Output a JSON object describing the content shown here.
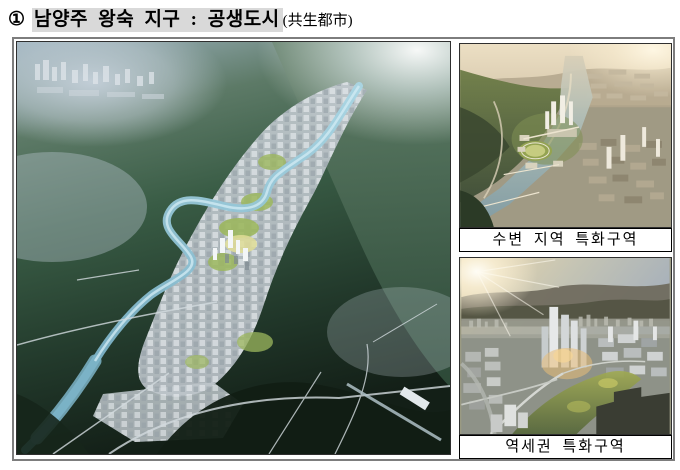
{
  "title": {
    "marker": "①",
    "highlighted": "남양주 왕숙 지구 : 공생도시",
    "suffix": "(共生都市)"
  },
  "captions": {
    "waterfront": "수변 지역 특화구역",
    "station": "역세권 특화구역"
  },
  "colors": {
    "title_highlight": "#d9d9d9",
    "outer_frame_border": "#7d7d7d",
    "image_border": "#2f2f2f",
    "caption_border": "#000000",
    "caption_background": "#ffffff",
    "river_blue": "#7fb4c8",
    "forest_green": "#2c4a37",
    "city_gray": "#c3cad0",
    "sunset_sky": "#ecd9ae"
  }
}
